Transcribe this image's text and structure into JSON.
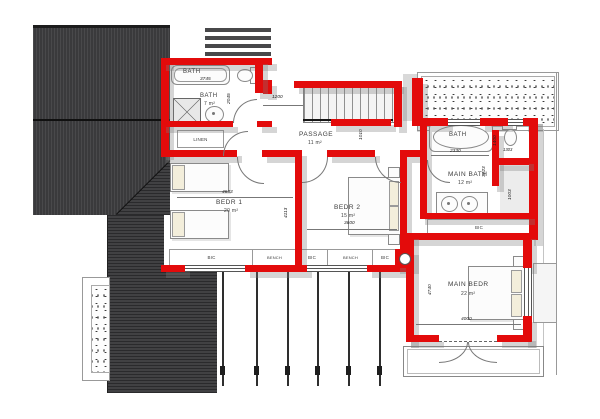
{
  "rooms": {
    "bath1": {
      "name": "BATH",
      "width_dim": "3745",
      "height_dim": "2045"
    },
    "bath2": {
      "name": "BATH",
      "area": "7 m²"
    },
    "linen": {
      "name": "LINEN"
    },
    "passage": {
      "name": "PASSAGE",
      "area": "11 m²",
      "dim_left": "1200",
      "dim_stair": "1010"
    },
    "bedroom1": {
      "name": "BEDR 1",
      "area": "20 m²",
      "width_dim": "4633",
      "height_dim": "4113"
    },
    "bedroom2": {
      "name": "BEDR 2",
      "area": "15 m²",
      "width_dim": "3600"
    },
    "main_bath": {
      "name": "MAIN BATH",
      "area": "12 m²",
      "tub_label": "BATH",
      "tub_dim": "2330",
      "wc_height_dim": "1400",
      "wc_width_dim": "1303",
      "height_dim": "3223",
      "closet_dim": "1003",
      "storage": "BIC"
    },
    "main_bedroom": {
      "name": "MAIN BEDR",
      "area": "22 m²",
      "height_dim": "4740",
      "width_dim": "4000"
    }
  },
  "joinery_strip": {
    "items": [
      "BIC",
      "BENCH",
      "BIC",
      "BENCH",
      "BIC"
    ]
  },
  "colors": {
    "wall": "#e30b0b",
    "roof": "#3a3a3c",
    "shadow": "#a8a8a8"
  }
}
